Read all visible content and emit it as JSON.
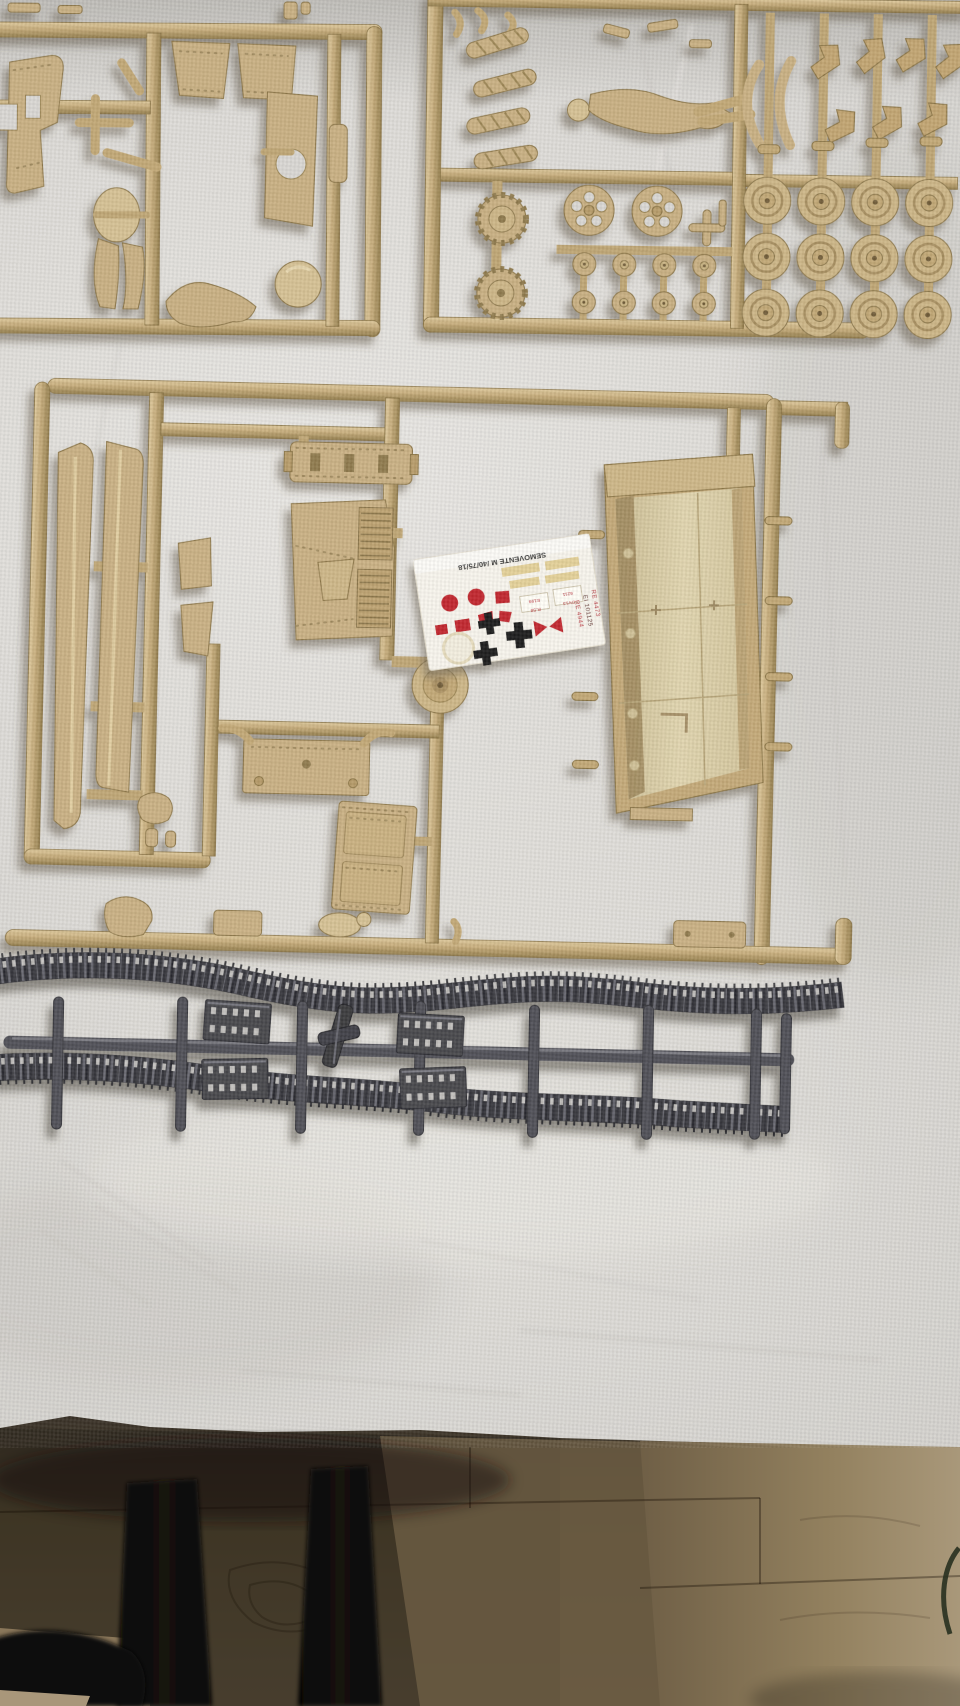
{
  "decal_sheet": {
    "title": "SEMOVENTE M /40/75/18",
    "registration_codes": [
      "RE 4473",
      "EI 101125",
      "RE 4944"
    ],
    "plate_box_1": [
      "E199",
      "R.58"
    ],
    "plate_box_2": [
      "6211",
      "DV13"
    ]
  },
  "colors": {
    "tan_plastic": "#c9b083",
    "gray_plastic": "#505056",
    "cloth": "#d6d4d0",
    "decal_paper": "#f7f4ec",
    "decal_red": "#c1272d",
    "decal_black": "#1c1c1c",
    "decal_yellow": "#e2cf94",
    "wood_floor": "#8d7b5c",
    "table_leg_black": "#0d0c0b"
  }
}
